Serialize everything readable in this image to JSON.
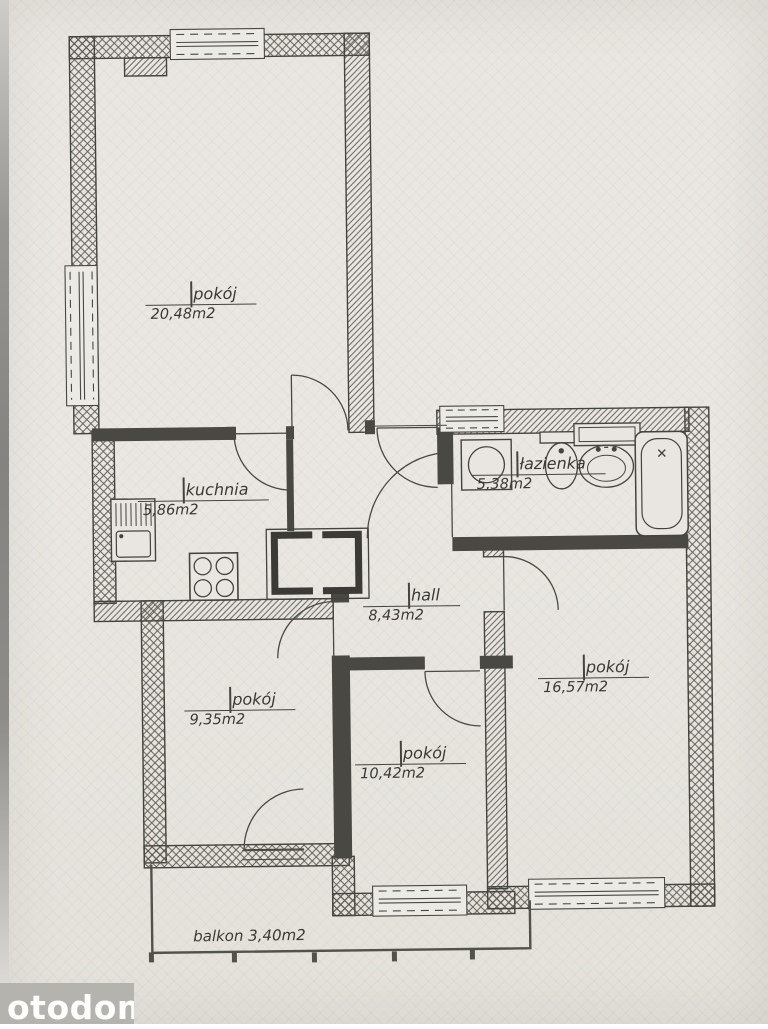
{
  "watermark": {
    "text": "otodom"
  },
  "rooms": [
    {
      "id": "pokoj-1",
      "name": "pokój",
      "area": "20,48m2"
    },
    {
      "id": "kuchnia",
      "name": "kuchnia",
      "area": "5,86m2"
    },
    {
      "id": "lazienka",
      "name": "łazienka",
      "area": "5,38m2"
    },
    {
      "id": "hall",
      "name": "hall",
      "area": "8,43m2"
    },
    {
      "id": "pokoj-2",
      "name": "pokój",
      "area": "9,35m2"
    },
    {
      "id": "pokoj-3",
      "name": "pokój",
      "area": "10,42m2"
    },
    {
      "id": "pokoj-4",
      "name": "pokój",
      "area": "16,57m2"
    }
  ],
  "balcony": {
    "label": "balkon  3,40m2"
  },
  "fixtures": [
    "kitchen-sink",
    "stove",
    "washing-machine",
    "toilet",
    "wash-basin",
    "bathtub"
  ],
  "colors": {
    "paper": "#e9e6e1",
    "line": "#45433d",
    "wall_hatch": "#55534c",
    "watermark_bg": "#b5b3ae",
    "watermark_text": "#fdfdfc"
  }
}
